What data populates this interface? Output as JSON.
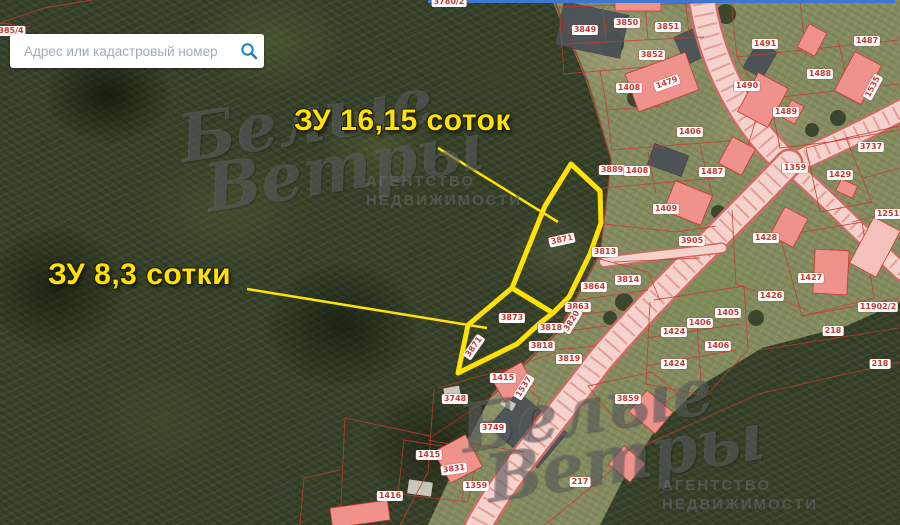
{
  "search": {
    "placeholder": "Адрес или кадастровый номер"
  },
  "annotations": [
    {
      "id": "plot-16-15",
      "text": "ЗУ 16,15 соток"
    },
    {
      "id": "plot-8-3",
      "text": "ЗУ 8,3 сотки"
    }
  ],
  "watermark": {
    "script_line1": "Белые",
    "script_line2": "Ветры",
    "agency_line1": "АГЕНТСТВО",
    "agency_line2": "НЕДВИЖИМОСТИ"
  },
  "colors": {
    "highlight_yellow": "#ffe204",
    "cadastral_red": "#c53b30",
    "road_pink": "#f5d2cc",
    "building_pink": "#ef928b",
    "search_blue": "#1b7bc0"
  },
  "parcel_labels": [
    {
      "text": "385/4",
      "x": 11,
      "y": 31,
      "rot": 0
    },
    {
      "text": "3780/2",
      "x": 449,
      "y": 2,
      "rot": 0
    },
    {
      "text": "3849",
      "x": 585,
      "y": 30,
      "rot": 0
    },
    {
      "text": "3850",
      "x": 627,
      "y": 23,
      "rot": 0
    },
    {
      "text": "3851",
      "x": 668,
      "y": 27,
      "rot": 0
    },
    {
      "text": "3852",
      "x": 652,
      "y": 55,
      "rot": 0
    },
    {
      "text": "1491",
      "x": 765,
      "y": 44,
      "rot": 0
    },
    {
      "text": "1487",
      "x": 867,
      "y": 41,
      "rot": 0
    },
    {
      "text": "1408",
      "x": 629,
      "y": 88,
      "rot": 0
    },
    {
      "text": "1479",
      "x": 667,
      "y": 83,
      "rot": -20
    },
    {
      "text": "1490",
      "x": 747,
      "y": 86,
      "rot": 0
    },
    {
      "text": "1488",
      "x": 820,
      "y": 74,
      "rot": 0
    },
    {
      "text": "1489",
      "x": 786,
      "y": 112,
      "rot": 0
    },
    {
      "text": "1535",
      "x": 873,
      "y": 87,
      "rot": -62
    },
    {
      "text": "1406",
      "x": 690,
      "y": 132,
      "rot": 0
    },
    {
      "text": "1487",
      "x": 712,
      "y": 172,
      "rot": 0
    },
    {
      "text": "1359",
      "x": 795,
      "y": 168,
      "rot": 0
    },
    {
      "text": "1429",
      "x": 840,
      "y": 175,
      "rot": 0
    },
    {
      "text": "3737",
      "x": 871,
      "y": 147,
      "rot": 0
    },
    {
      "text": "1251",
      "x": 888,
      "y": 214,
      "rot": 0
    },
    {
      "text": "1409",
      "x": 666,
      "y": 209,
      "rot": 0
    },
    {
      "text": "3905",
      "x": 692,
      "y": 241,
      "rot": 0
    },
    {
      "text": "1428",
      "x": 766,
      "y": 238,
      "rot": 0
    },
    {
      "text": "3889",
      "x": 612,
      "y": 170,
      "rot": 0
    },
    {
      "text": "1408",
      "x": 637,
      "y": 171,
      "rot": 0
    },
    {
      "text": "3871",
      "x": 562,
      "y": 240,
      "rot": -12
    },
    {
      "text": "3813",
      "x": 605,
      "y": 252,
      "rot": 0
    },
    {
      "text": "3814",
      "x": 628,
      "y": 280,
      "rot": 0
    },
    {
      "text": "3864",
      "x": 594,
      "y": 287,
      "rot": 0
    },
    {
      "text": "3863",
      "x": 578,
      "y": 307,
      "rot": 0
    },
    {
      "text": "3820",
      "x": 572,
      "y": 321,
      "rot": -58
    },
    {
      "text": "3818",
      "x": 551,
      "y": 328,
      "rot": 0
    },
    {
      "text": "3818",
      "x": 542,
      "y": 346,
      "rot": 0
    },
    {
      "text": "3819",
      "x": 569,
      "y": 359,
      "rot": 0
    },
    {
      "text": "3873",
      "x": 512,
      "y": 318,
      "rot": 0
    },
    {
      "text": "3871",
      "x": 474,
      "y": 347,
      "rot": -55
    },
    {
      "text": "1415",
      "x": 503,
      "y": 378,
      "rot": 0
    },
    {
      "text": "1537",
      "x": 524,
      "y": 387,
      "rot": -58
    },
    {
      "text": "3748",
      "x": 455,
      "y": 399,
      "rot": 0
    },
    {
      "text": "3749",
      "x": 493,
      "y": 428,
      "rot": 0
    },
    {
      "text": "1426",
      "x": 771,
      "y": 296,
      "rot": 0
    },
    {
      "text": "1427",
      "x": 811,
      "y": 278,
      "rot": 0
    },
    {
      "text": "11902/2",
      "x": 878,
      "y": 307,
      "rot": 0
    },
    {
      "text": "218",
      "x": 833,
      "y": 331,
      "rot": 0
    },
    {
      "text": "218",
      "x": 880,
      "y": 364,
      "rot": 0
    },
    {
      "text": "1405",
      "x": 728,
      "y": 313,
      "rot": 0
    },
    {
      "text": "1406",
      "x": 700,
      "y": 323,
      "rot": 0
    },
    {
      "text": "1424",
      "x": 674,
      "y": 332,
      "rot": 0
    },
    {
      "text": "1406",
      "x": 718,
      "y": 346,
      "rot": 0
    },
    {
      "text": "1424",
      "x": 674,
      "y": 364,
      "rot": 0
    },
    {
      "text": "3859",
      "x": 628,
      "y": 399,
      "rot": 0
    },
    {
      "text": "217",
      "x": 580,
      "y": 482,
      "rot": 0
    },
    {
      "text": "1359",
      "x": 476,
      "y": 486,
      "rot": 0
    },
    {
      "text": "1416",
      "x": 390,
      "y": 496,
      "rot": 0
    },
    {
      "text": "1415",
      "x": 429,
      "y": 455,
      "rot": 0
    },
    {
      "text": "3831",
      "x": 454,
      "y": 469,
      "rot": -8
    }
  ]
}
